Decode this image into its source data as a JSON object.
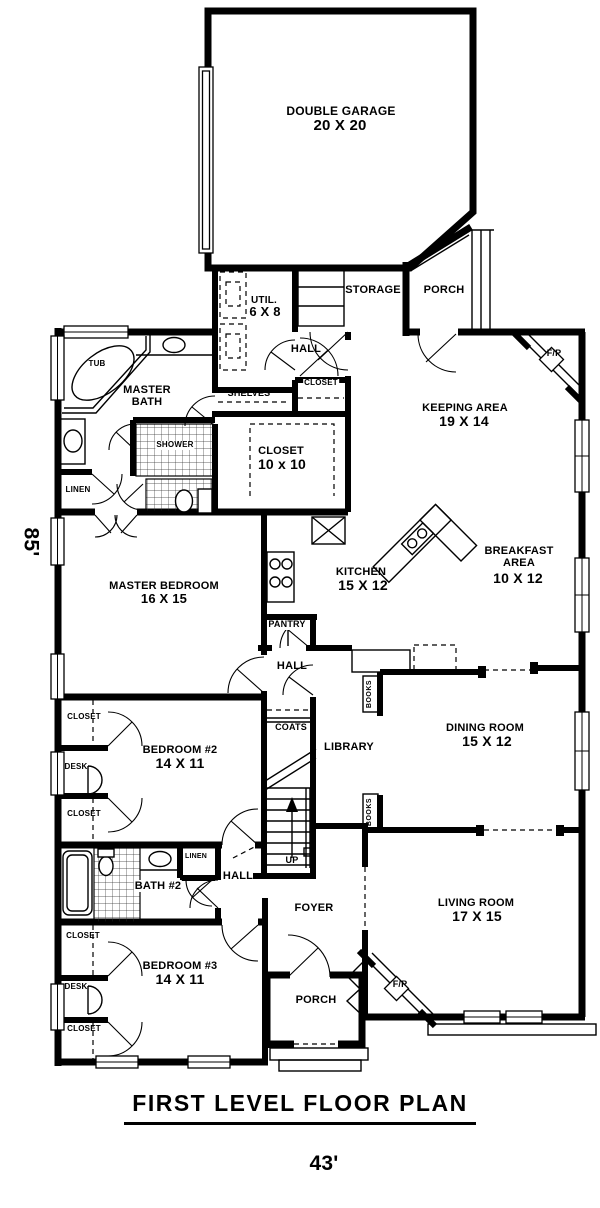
{
  "page": {
    "title": "FIRST LEVEL FLOOR PLAN",
    "width_dim": "43'",
    "depth_dim": "85'"
  },
  "rooms": {
    "garage": {
      "name": "DOUBLE GARAGE",
      "size": "20 X 20"
    },
    "util": {
      "name": "UTIL.",
      "size": "6 X 8"
    },
    "keeping": {
      "name": "KEEPING AREA",
      "size": "19 X 14"
    },
    "closet10": {
      "name": "CLOSET",
      "size": "10 x 10"
    },
    "kitchen": {
      "name": "KITCHEN",
      "size": "15 X 12"
    },
    "breakfast": {
      "name": "BREAKFAST AREA",
      "size": "10 X 12"
    },
    "master_bedroom": {
      "name": "MASTER BEDROOM",
      "size": "16 X 15"
    },
    "master_bath": {
      "name": "MASTER BATH"
    },
    "dining": {
      "name": "DINING ROOM",
      "size": "15 X 12"
    },
    "library": {
      "name": "LIBRARY"
    },
    "bedroom2": {
      "name": "BEDROOM #2",
      "size": "14 X 11"
    },
    "bedroom3": {
      "name": "BEDROOM #3",
      "size": "14 X 11"
    },
    "bath2": {
      "name": "BATH #2"
    },
    "living": {
      "name": "LIVING ROOM",
      "size": "17 X 15"
    },
    "foyer": {
      "name": "FOYER"
    }
  },
  "labels": {
    "storage": "STORAGE",
    "porch": "PORCH",
    "hall": "HALL",
    "closet": "CLOSET",
    "shelves": "SHELVES",
    "tub": "TUB",
    "shower": "SHOWER",
    "linen": "LINEN",
    "pantry": "PANTRY",
    "coats": "COATS",
    "books": "BOOKS",
    "up": "UP",
    "desk": "DESK",
    "fireplace": "F/P"
  },
  "colors": {
    "line": "#000000",
    "background": "#ffffff"
  }
}
